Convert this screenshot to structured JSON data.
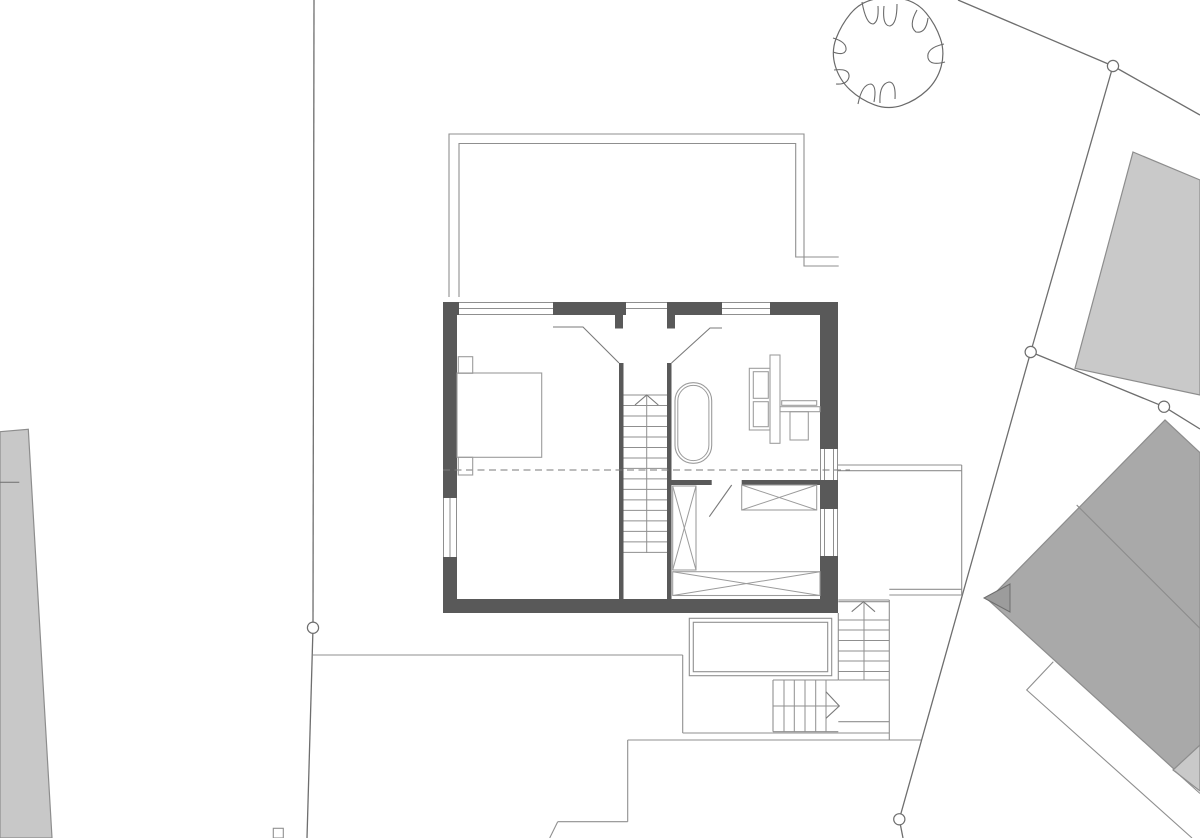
{
  "document": {
    "type": "architectural-floor-plan",
    "description": "Upper floor plan of a detached house on a site plan with property boundaries, survey points, neighbouring buildings and a tree symbol. Drawing contains no text labels."
  },
  "canvas": {
    "width": 1200,
    "height": 838,
    "background": "#ffffff"
  },
  "colors": {
    "wall_fill": "#595959",
    "thin_line": "#8f8f8f",
    "medium_line": "#7a7a7a",
    "site_line": "#6e6e6e",
    "furniture_line": "#9b9b9b",
    "dash_line": "#7a7a7a",
    "building_light": "#c9c9c9",
    "building_west": "#c8c8c8",
    "building_dark": "#a9a9a9",
    "building_outline": "#8d8d8d",
    "arrow_fill": "#9c9c9c",
    "tree_line": "#6a6a6a",
    "circle_fill": "#ffffff"
  },
  "site": {
    "boundary_lines": [
      [
        958,
        0,
        1113,
        66
      ],
      [
        1113,
        66,
        1200,
        115
      ],
      [
        1113,
        66,
        1030.7,
        352
      ],
      [
        1030.7,
        352,
        1164,
        406.7
      ],
      [
        1164,
        406.7,
        1200,
        429
      ],
      [
        1030.7,
        352,
        899.3,
        819.3
      ],
      [
        899.3,
        819.3,
        903,
        838
      ],
      [
        314,
        0,
        313,
        627.7
      ],
      [
        313,
        627.7,
        307,
        838
      ]
    ],
    "survey_circles": [
      [
        1113,
        66
      ],
      [
        1030.7,
        352
      ],
      [
        1164,
        406.7
      ],
      [
        313,
        627.7
      ],
      [
        899.3,
        819.3
      ]
    ],
    "circle_radius": 5.6,
    "marker_rect": [
      273.3,
      828.3,
      10,
      9.7
    ],
    "neighbor_buildings": [
      {
        "name": "west-building",
        "fill": "#c8c8c8",
        "points": [
          [
            0,
            431.7
          ],
          [
            28.3,
            429.3
          ],
          [
            52,
            838
          ],
          [
            0,
            838
          ]
        ],
        "notch_line": [
          0,
          482.3,
          19.3,
          482.3
        ]
      },
      {
        "name": "northeast-building",
        "fill": "#c9c9c9",
        "points": [
          [
            1133,
            152
          ],
          [
            1200,
            180
          ],
          [
            1200,
            395
          ],
          [
            1075,
            368.3
          ]
        ]
      },
      {
        "name": "southeast-building",
        "fill": "#a9a9a9",
        "points": [
          [
            1165,
            420
          ],
          [
            1200,
            452.7
          ],
          [
            1200,
            790
          ],
          [
            1175,
            770
          ],
          [
            988.3,
            600
          ]
        ],
        "ridge": [
          1076.7,
          505,
          1200,
          628.3
        ]
      },
      {
        "name": "southeast-corner-building",
        "fill": "#c9c9c9",
        "points": [
          [
            1173,
            770
          ],
          [
            1200,
            745
          ],
          [
            1200,
            791
          ]
        ]
      }
    ],
    "outline_polylines": [
      [
        [
          1053.3,
          661.7
        ],
        [
          1026.7,
          690
        ],
        [
          1192,
          838
        ]
      ],
      [
        [
          1175,
          771
        ],
        [
          1200,
          793.5
        ]
      ]
    ],
    "ground_lines": [
      [
        313,
        655,
        682.7,
        655
      ],
      [
        682.7,
        655,
        682.7,
        733
      ],
      [
        682.7,
        733,
        889.3,
        733
      ],
      [
        838.3,
        721.7,
        889.3,
        721.7
      ],
      [
        627.7,
        740,
        921.5,
        740
      ],
      [
        627.7,
        740,
        627.7,
        821.7
      ],
      [
        557.7,
        821.7,
        627.7,
        821.7
      ],
      [
        557.7,
        821.7,
        549.7,
        838
      ]
    ],
    "entrance_arrow": [
      [
        984,
        598
      ],
      [
        1010,
        584
      ],
      [
        1010,
        612
      ]
    ],
    "tree": {
      "outer_path": "M941.2,66.3 Q945,52 940.3,38.3 Q935.6,24.5 926.3,13.2 Q917,1.8 902.5,-1.1 Q888,-4 873.8,-0.7 Q859.5,2.6 850.4,13.8 Q841.2,25 836.1,38.5 Q831,52 835.3,66 Q839.5,80 850,89.8 Q860.5,99.6 874.3,104.8 Q888,110 902,105.3 Q916,100.5 926.7,90.5 Q937.4,80.5 941.2,66.3 Z",
      "curl_paths": [
        "M862,2 Q866,24 873,24 Q879,22 878,6",
        "M884,6 Q882,26 890,26 Q897,24 897,4",
        "M917,10 Q908,26 916,32 Q926,34 928,18",
        "M944,44 Q926,48 928,58 Q930,66 945,62",
        "M858,104 Q862,84 871,84 Q877,86 874,102",
        "M880,103 Q879,84 889,82 Q896,82 895,99",
        "M833,38 Q847,42 846,50 Q844,56 833,52",
        "M834,70 Q850,68 849,77 Q847,85 836,84"
      ]
    }
  },
  "house": {
    "walls": [
      [
        443,
        302,
        16,
        13
      ],
      [
        553,
        302,
        73,
        13
      ],
      [
        667,
        302,
        55,
        13
      ],
      [
        770,
        302,
        68,
        13
      ],
      [
        443,
        302,
        14,
        196
      ],
      [
        443,
        557,
        14,
        56
      ],
      [
        820,
        302,
        18,
        147
      ],
      [
        820,
        480,
        18,
        29
      ],
      [
        820,
        556,
        18,
        57
      ],
      [
        443,
        599,
        395,
        14
      ],
      [
        619,
        363,
        4.5,
        236
      ],
      [
        667,
        363,
        4.5,
        236
      ],
      [
        671.5,
        480,
        40.2,
        5
      ],
      [
        741.7,
        480,
        78.3,
        5
      ],
      [
        615,
        315,
        8,
        13.5
      ],
      [
        667,
        315,
        8,
        13.5
      ]
    ],
    "window_lines": [
      [
        459,
        302.5,
        553,
        302.5
      ],
      [
        459,
        308.5,
        553,
        308.5
      ],
      [
        459,
        314.5,
        553,
        314.5
      ],
      [
        626,
        302.5,
        667,
        302.5
      ],
      [
        626,
        308.5,
        667,
        308.5
      ],
      [
        722,
        302.5,
        770,
        302.5
      ],
      [
        722,
        308.5,
        770,
        308.5
      ],
      [
        722,
        314.5,
        770,
        314.5
      ],
      [
        443.5,
        498,
        443.5,
        557
      ],
      [
        450,
        498,
        450,
        557
      ],
      [
        456.5,
        498,
        456.5,
        557
      ],
      [
        820.5,
        449,
        820.5,
        480
      ],
      [
        824.5,
        449,
        824.5,
        480
      ],
      [
        833.5,
        449,
        833.5,
        480
      ],
      [
        837.5,
        449,
        837.5,
        480
      ],
      [
        820.5,
        509,
        820.5,
        556
      ],
      [
        824.5,
        509,
        824.5,
        556
      ],
      [
        833.5,
        509,
        833.5,
        556
      ],
      [
        837.5,
        509,
        837.5,
        556
      ]
    ],
    "terrace": {
      "outer": [
        [
          449,
          297
        ],
        [
          449,
          134
        ],
        [
          804,
          134
        ],
        [
          804,
          266
        ],
        [
          838.7,
          266
        ]
      ],
      "inner": [
        [
          459,
          297
        ],
        [
          459,
          143.5
        ],
        [
          795.7,
          143.5
        ],
        [
          795.7,
          257
        ],
        [
          838.7,
          257
        ]
      ]
    },
    "funnel_lines": [
      [
        [
          553,
          327
        ],
        [
          583,
          327
        ],
        [
          619,
          363
        ]
      ],
      [
        [
          722,
          328
        ],
        [
          710,
          328
        ],
        [
          671.5,
          363
        ]
      ]
    ],
    "stair_main": {
      "x1": 623.5,
      "x2": 667,
      "tread_y_start": 395,
      "tread_step": 10.49,
      "tread_count": 16,
      "center_x": 646.7,
      "center_y1": 395,
      "center_y2": 553,
      "arrow": [
        [
          635,
          405
        ],
        [
          646.7,
          395
        ],
        [
          658.3,
          405
        ]
      ]
    },
    "dashed_line": [
      443,
      470,
      850,
      470
    ],
    "annex_lines": [
      [
        838,
        465,
        961.7,
        465
      ],
      [
        838,
        470.7,
        961.7,
        470.7
      ],
      [
        961.7,
        465,
        961.7,
        595
      ],
      [
        889.3,
        589.3,
        961.7,
        589.3
      ],
      [
        889.3,
        595,
        961.7,
        595
      ]
    ],
    "balcony": {
      "outer": [
        689.3,
        618.3,
        142.4,
        57.4
      ],
      "inner": [
        693.3,
        622.3,
        134.4,
        49.4
      ]
    },
    "ext_stair": {
      "x1": 838.3,
      "x2": 889.3,
      "top_lines": [
        600,
        601.7
      ],
      "treads": [
        620,
        630,
        640.5,
        651,
        661,
        671.5,
        680
      ],
      "center_x": 864,
      "center_y1": 602,
      "center_y2": 680,
      "left_edge": [
        838.3,
        613,
        838.3,
        680
      ],
      "right_edge": [
        889.3,
        600,
        889.3,
        740
      ],
      "arrow": [
        [
          851.7,
          611.7
        ],
        [
          863.5,
          601.7
        ],
        [
          875,
          611.7
        ]
      ]
    },
    "lower_flight": {
      "y1": 680,
      "y2": 731.7,
      "x_left": 773,
      "x_right": 838.3,
      "treads_x": [
        784,
        794.3,
        805,
        815.7,
        826
      ],
      "center_y": 706,
      "arrow": [
        [
          826,
          691.7
        ],
        [
          839.3,
          706
        ],
        [
          826,
          718.3
        ]
      ]
    },
    "furniture": {
      "bed": {
        "body": [
          457,
          373,
          84.7,
          84.3
        ],
        "nightstands": [
          [
            458.3,
            356.7,
            14.4,
            16.6
          ],
          [
            458.3,
            457.3,
            14.4,
            17.7
          ]
        ]
      },
      "bathtub": {
        "outer": [
          675,
          382.7,
          36.7,
          80.6,
          18
        ],
        "inner": [
          677.8,
          385.4,
          31.1,
          75.2,
          15.5
        ]
      },
      "vanity_rects": [
        [
          749.3,
          368.3,
          20.7,
          61.7
        ],
        [
          753.3,
          371.7,
          15,
          26.6
        ],
        [
          753.3,
          401.7,
          15,
          25
        ],
        [
          770,
          355,
          10,
          88.3
        ],
        [
          780,
          406.7,
          40,
          5
        ],
        [
          781.7,
          400.7,
          35,
          4.6
        ],
        [
          790,
          411.7,
          18.3,
          28.3
        ]
      ],
      "wardrobes": [
        [
          741.7,
          485,
          75,
          25
        ],
        [
          672.7,
          486,
          23.3,
          84
        ],
        [
          672.7,
          571.7,
          147.3,
          23.8
        ]
      ],
      "door_leaf": [
        731.7,
        485,
        709.3,
        516.7
      ]
    }
  }
}
